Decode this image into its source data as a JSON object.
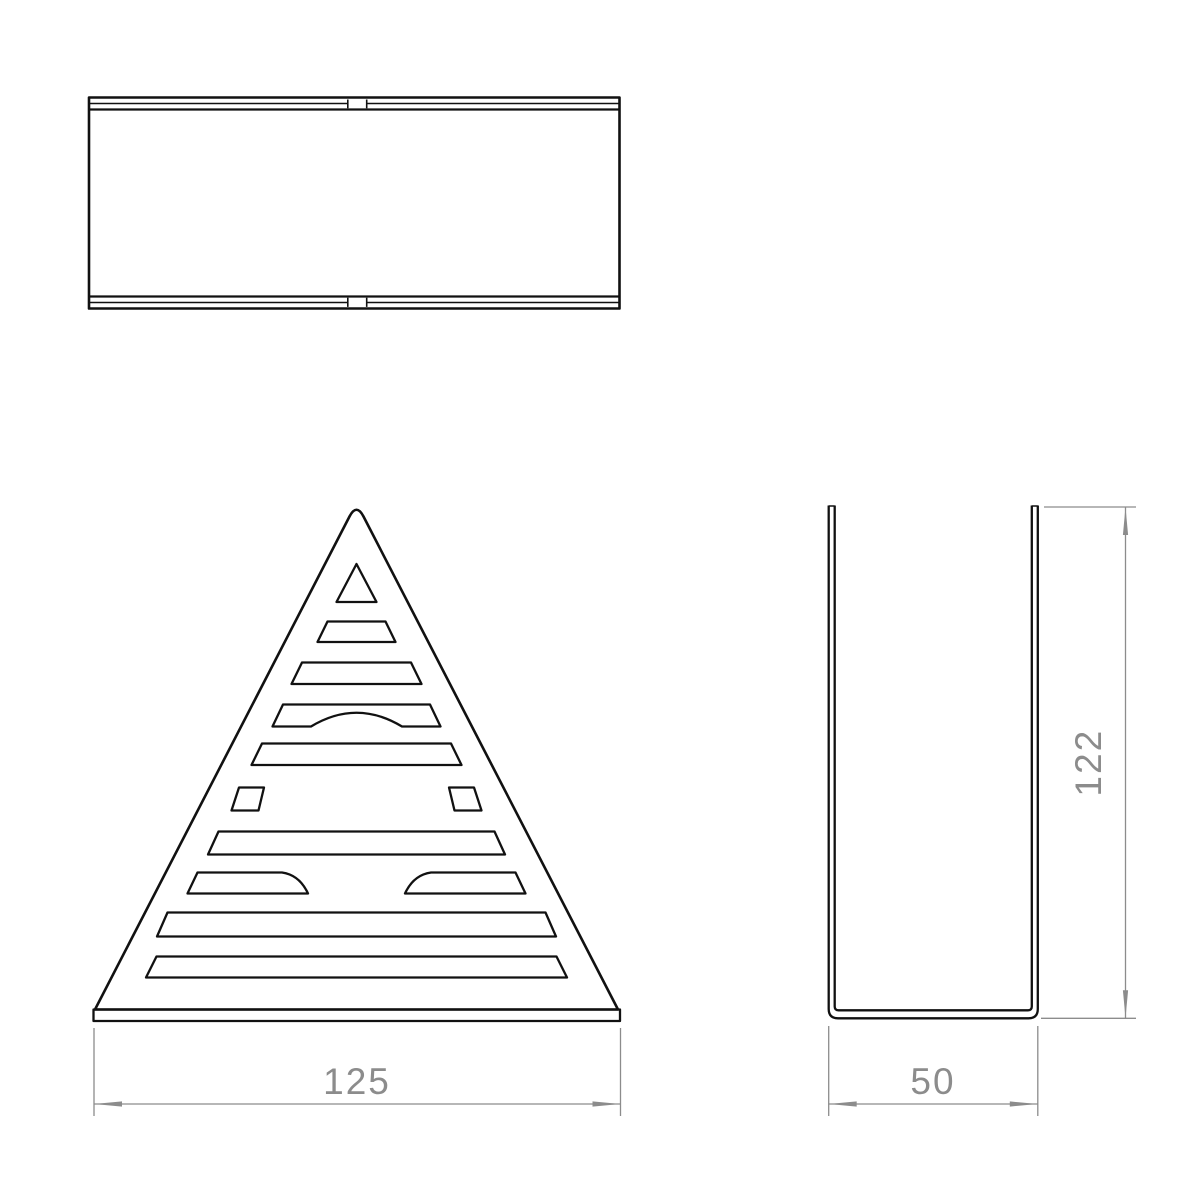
{
  "colors": {
    "background": "#ffffff",
    "geometry": "#111111",
    "dimension": "#8c8c8c"
  },
  "views": [
    {
      "name": "top-view"
    },
    {
      "name": "front-view"
    },
    {
      "name": "side-view"
    }
  ],
  "dimensions": [
    {
      "name": "front-width",
      "label": "125",
      "orientation": "horizontal"
    },
    {
      "name": "side-width",
      "label": "50",
      "orientation": "horizontal"
    },
    {
      "name": "side-height",
      "label": "122",
      "orientation": "vertical"
    }
  ]
}
